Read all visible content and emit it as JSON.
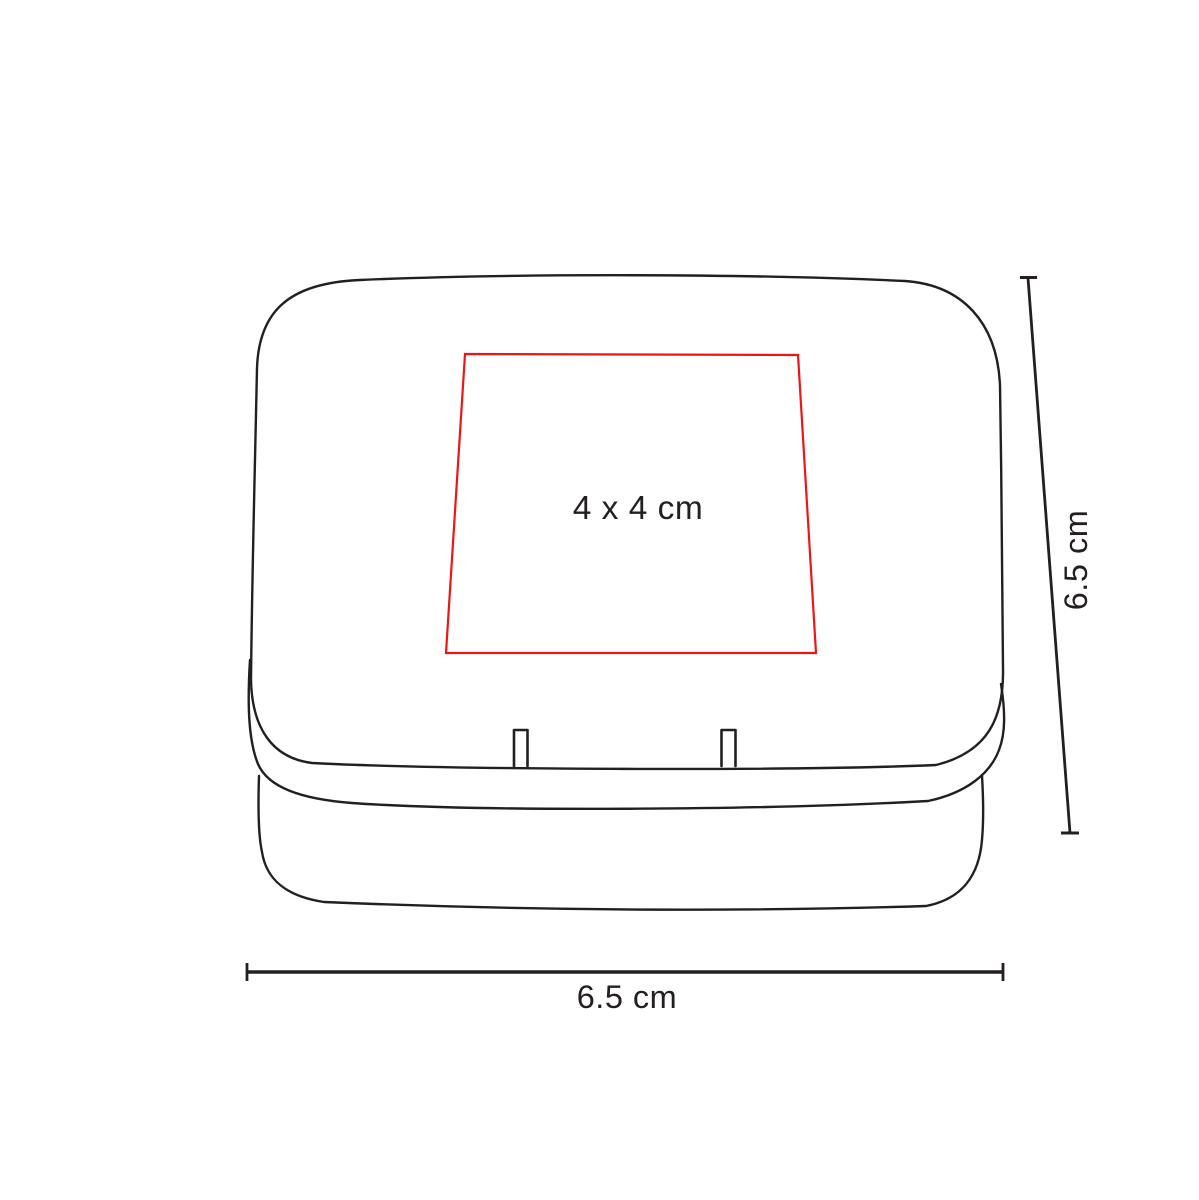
{
  "diagram": {
    "object": "hinged-tin-box-line-drawing",
    "colors": {
      "line": "#231f20",
      "text": "#231f20",
      "imprint_outline": "#ed1616",
      "background": "#ffffff"
    },
    "imprint_area": {
      "label": "4 x 4 cm"
    },
    "dimensions": [
      {
        "axis": "height",
        "position": "right",
        "label": "6.5 cm"
      },
      {
        "axis": "width",
        "position": "bottom",
        "label": "6.5 cm"
      }
    ]
  }
}
